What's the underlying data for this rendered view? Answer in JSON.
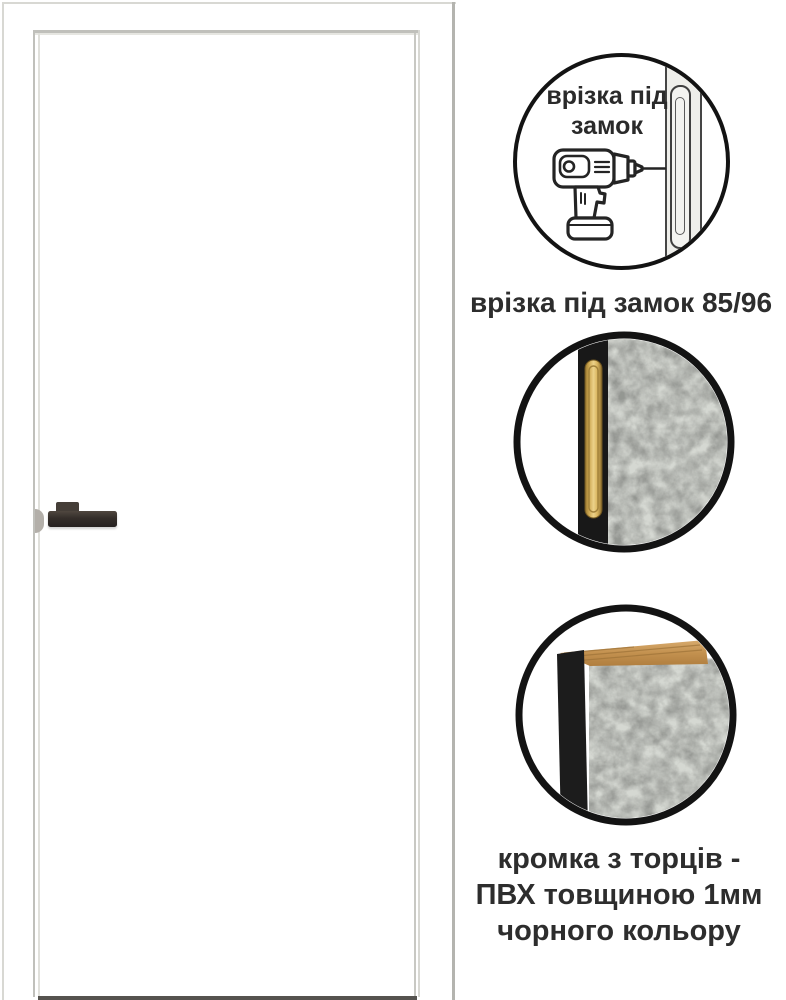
{
  "door": {
    "leaf_color": "#ffffff",
    "frame_line_color": "#c0c0bb",
    "handle_color": "#342e2a",
    "strike_plate_color": "#b3afa9",
    "floor_shadow_color": "#55534f"
  },
  "callouts": {
    "lock_cutout": {
      "bubble_label_lines": [
        "врізка під",
        "замок"
      ],
      "caption": "врізка під замок 85/96",
      "icon": "drill-icon"
    },
    "edge_detail": {
      "caption_lines": [
        "кромка з торців -",
        "ПВХ товщиною 1мм",
        "чорного кольору"
      ]
    },
    "colors": {
      "circle_border": "#131313",
      "pvc_edge_black": "#1a1a1a",
      "brass_faceplate": "#d8b563",
      "concrete_surface": "#d4d7d1",
      "wood_core": "#c79a5f",
      "caption_text": "#2d2d2d"
    }
  }
}
